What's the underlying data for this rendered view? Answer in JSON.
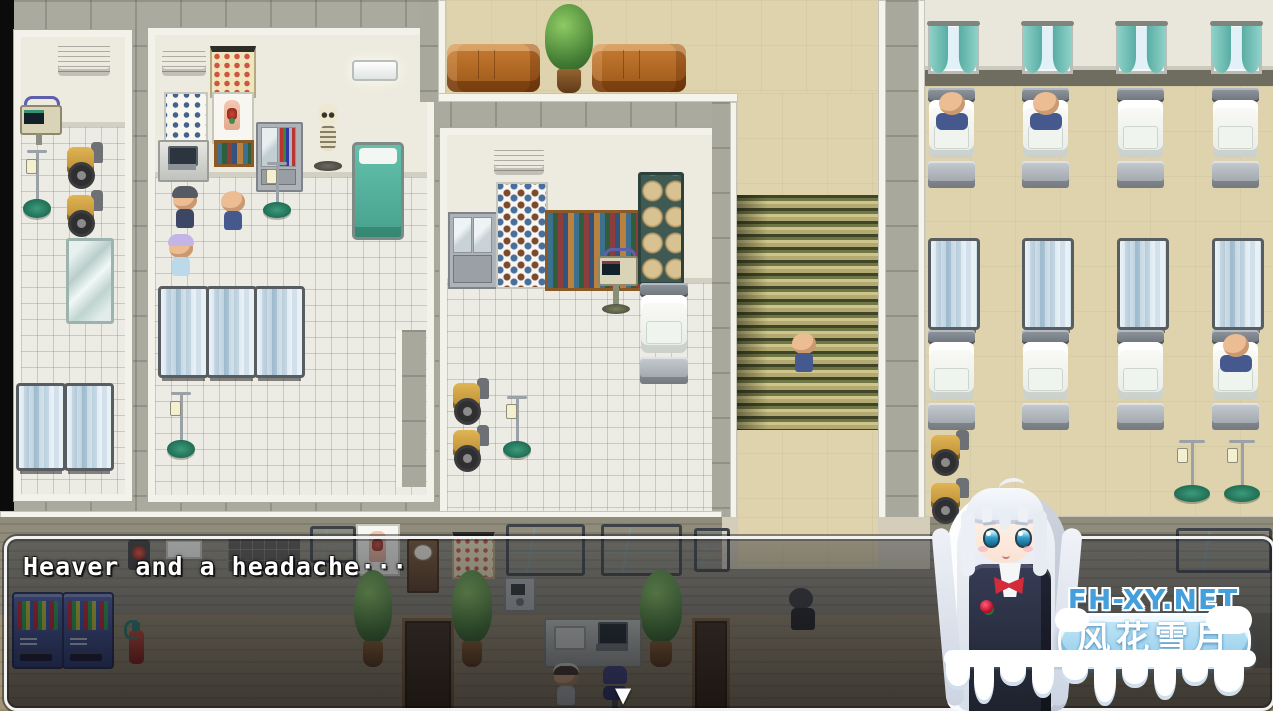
{
  "window": {
    "type": "rpg-game-screen",
    "scene": "hospital-interior-map"
  },
  "dialogue": {
    "text": "Heaver and a headache···",
    "continue_symbol": "▼"
  },
  "watermark": {
    "site": "FH-XY.NET",
    "brand": "风花雪月"
  },
  "colors": {
    "dialog_border": "#f2f2f2",
    "dialog_background": "rgba(15,16,22,0.55)",
    "watermark_site_blue": "#459fdc",
    "watermark_pill_blue": "#a9d7ef",
    "stairs_olive": "#707644",
    "curtain_teal": "#74c4bc",
    "wheelchair_yellow": "#d2a94e",
    "couch_brown": "#b06a2a",
    "vending_machine_blue": "#3d54a5",
    "green_bed_teal": "#55b59f"
  },
  "scene": {
    "rooms": [
      "equipment-room",
      "examination-room",
      "pharmacy-storage-room",
      "waiting-area",
      "stairwell",
      "hospital-ward",
      "lobby-reception"
    ],
    "characters": [
      "doctor",
      "bald-patient",
      "nurse",
      "bald-man-on-stairs",
      "ward-patient-1",
      "ward-patient-2",
      "ward-patient-3",
      "receptionist-maid",
      "sitting-visitor"
    ],
    "furniture": [
      "medical-monitor",
      "iv-stand",
      "wheelchair",
      "mirror",
      "privacy-screen",
      "hospital-bed",
      "skeleton-model",
      "eye-chart",
      "anatomy-poster",
      "wall-calendar",
      "medicine-cabinet",
      "bookshelf",
      "storage-rack",
      "couch",
      "potted-plant",
      "vending-machine",
      "fire-extinguisher",
      "grandfather-clock",
      "wall-tv",
      "wall-monitor",
      "wall-phone",
      "reception-desk",
      "office-chair",
      "doormat",
      "window-with-curtains",
      "air-conditioner"
    ]
  }
}
